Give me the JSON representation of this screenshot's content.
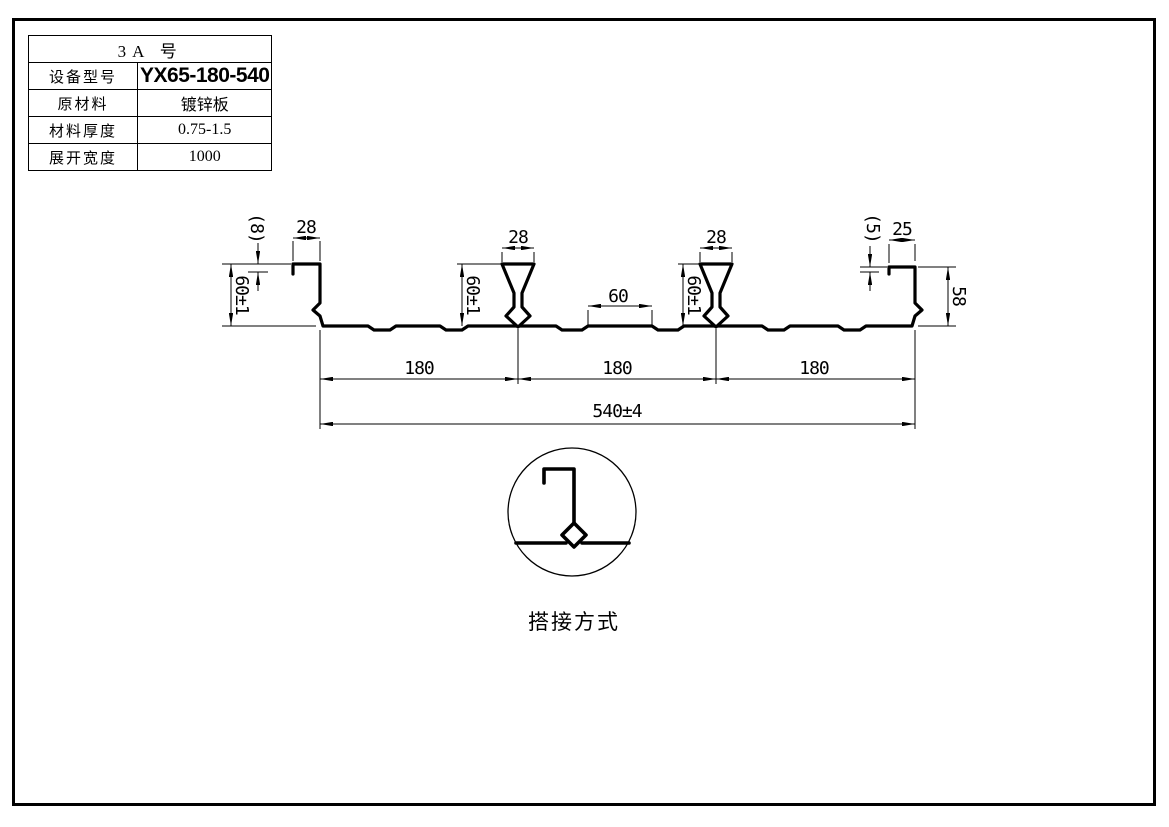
{
  "table": {
    "header": "3A  号",
    "rows": [
      {
        "label": "设备型号",
        "value": "YX65-180-540"
      },
      {
        "label": "原材料",
        "value": "镀锌板"
      },
      {
        "label": "材料厚度",
        "value": "0.75-1.5"
      },
      {
        "label": "展开宽度",
        "value": "1000"
      }
    ]
  },
  "drawing": {
    "dims": {
      "lip_left": "(8)",
      "flange_left": "28",
      "height_left": "60±1",
      "rib1_top": "28",
      "rib1_height": "60±1",
      "stiffener_gap": "60",
      "rib2_top": "28",
      "rib2_height": "60±1",
      "lip_right": "(5)",
      "flange_right": "25",
      "height_right": "58",
      "pitch1": "180",
      "pitch2": "180",
      "pitch3": "180",
      "overall": "540±4"
    },
    "caption": "搭接方式"
  },
  "colors": {
    "line": "#000000",
    "background": "#ffffff"
  }
}
